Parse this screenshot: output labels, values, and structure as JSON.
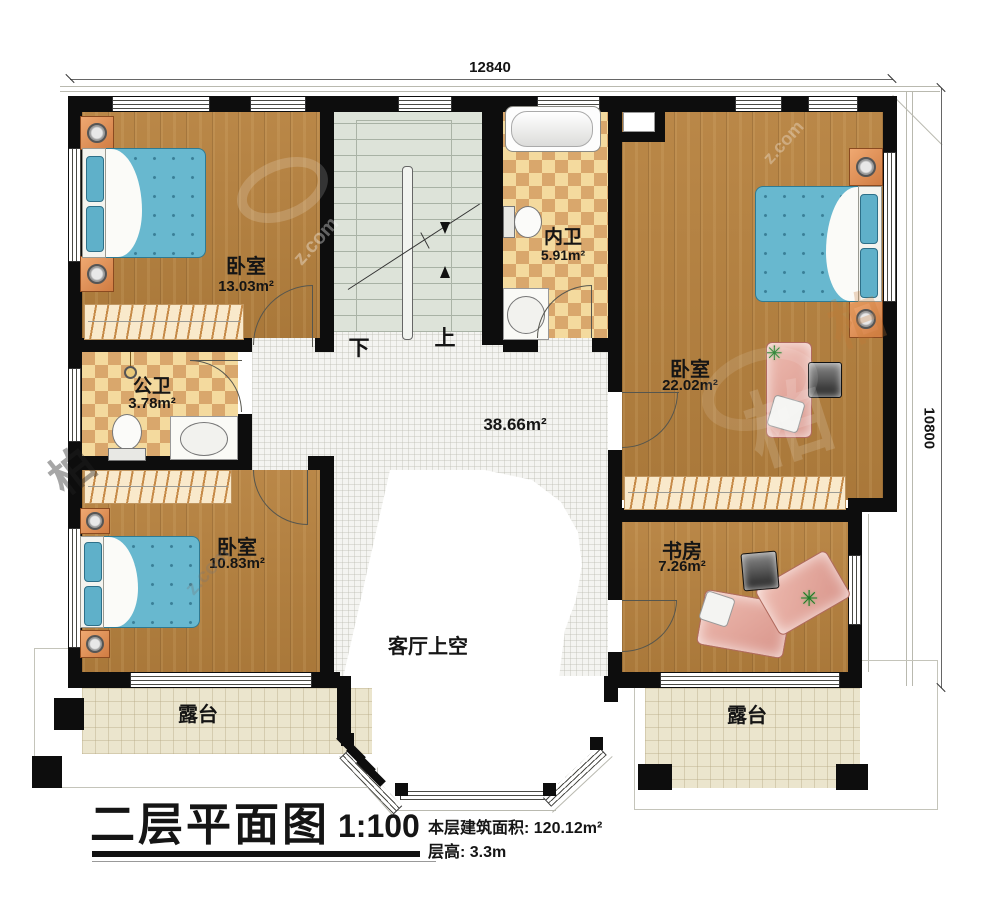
{
  "meta": {
    "title": "二层平面图",
    "scale": "1:100",
    "floor_area_label": "本层建筑面积: 120.12m²",
    "floor_height_label": "层高: 3.3m"
  },
  "dimensions": {
    "top": "12840",
    "right": "10800"
  },
  "stairs": {
    "down_label": "下",
    "up_label": "上"
  },
  "rooms": {
    "bedroom_top_left": {
      "name": "卧室",
      "area": "13.03m²"
    },
    "inner_bathroom": {
      "name": "内卫",
      "area": "5.91m²"
    },
    "bedroom_right": {
      "name": "卧室",
      "area": "22.02m²"
    },
    "public_bathroom": {
      "name": "公卫",
      "area": "3.78m²"
    },
    "bedroom_bottom_left": {
      "name": "卧室",
      "area": "10.83m²"
    },
    "study": {
      "name": "书房",
      "area": "7.26m²"
    },
    "hall": {
      "area": "38.66m²"
    },
    "living_room_void": {
      "name": "客厅上空"
    },
    "terrace_left": {
      "name": "露台"
    },
    "terrace_right": {
      "name": "露台"
    }
  },
  "icons": {
    "plant": "✳"
  },
  "watermark": {
    "logo_text": "柏",
    "url_text": "z.com"
  },
  "colors": {
    "wall": "#0d0d0d",
    "wood": "#b6813e",
    "tile_light": "#f4da9e",
    "tile_dark": "#d9a76c",
    "stairs": "#dde3d9",
    "terrace": "#ebe5cd",
    "bed_blue": "#68b8cf",
    "desk_pink": "#e2a193"
  }
}
